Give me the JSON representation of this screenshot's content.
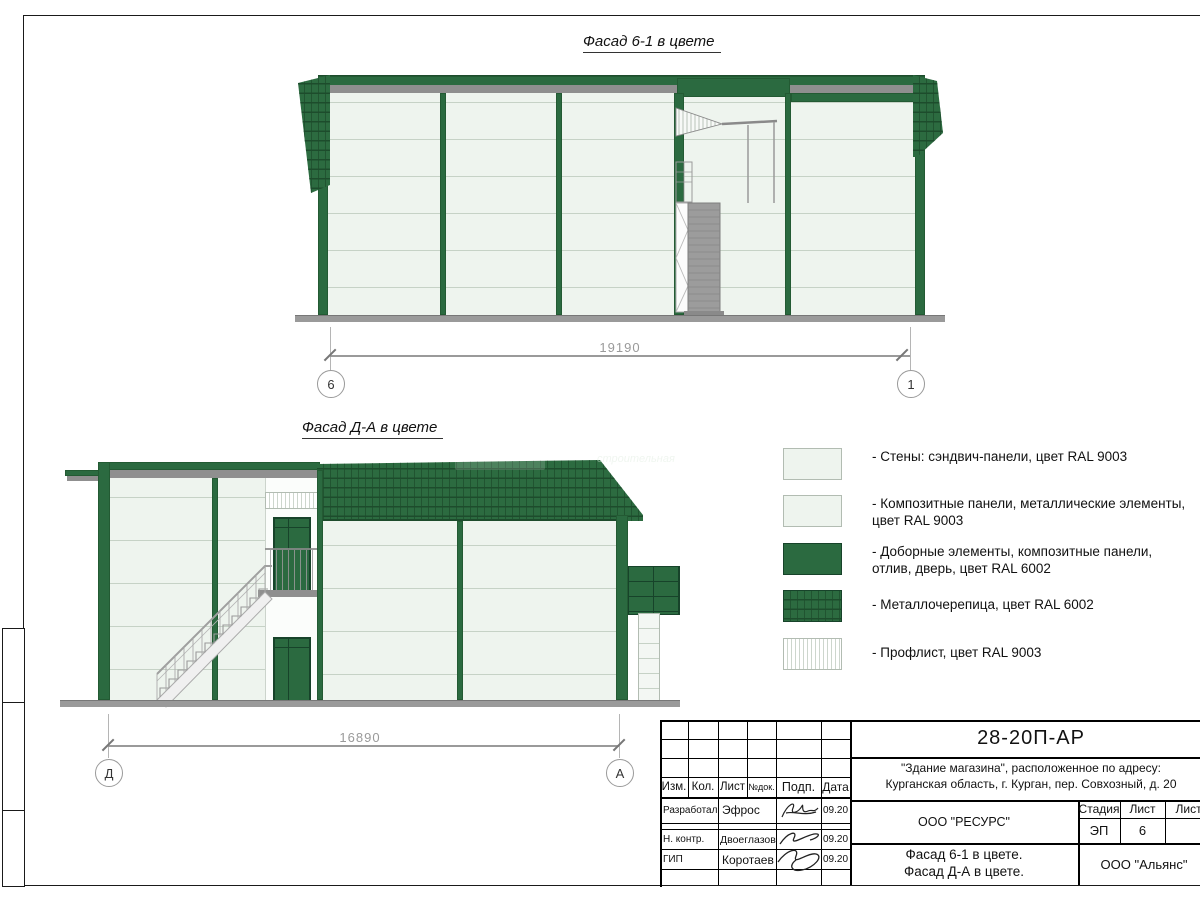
{
  "facades": {
    "f1": {
      "title": "Фасад 6-1 в цвете",
      "dimension": "19190",
      "axis_left": "6",
      "axis_right": "1"
    },
    "f2": {
      "title": "Фасад Д-А в цвете",
      "dimension": "16890",
      "axis_left": "Д",
      "axis_right": "А"
    }
  },
  "legend": {
    "items": [
      {
        "swatch": "plain-light",
        "lines": [
          "- Стены: сэндвич-панели, цвет RAL 9003"
        ]
      },
      {
        "swatch": "plain-light",
        "lines": [
          "- Композитные панели, металлические элементы,",
          "цвет RAL 9003"
        ]
      },
      {
        "swatch": "solid-green",
        "lines": [
          "- Доборные элементы,  композитные панели,",
          "отлив, дверь, цвет RAL 6002"
        ]
      },
      {
        "swatch": "tile-green",
        "lines": [
          "- Металлочерепица, цвет RAL 6002"
        ]
      },
      {
        "swatch": "proflist-light",
        "lines": [
          "- Профлист, цвет RAL 9003"
        ]
      }
    ]
  },
  "watermark": {
    "text": "строительная"
  },
  "title_block": {
    "doc_number": "28-20П-АР",
    "address_line1": "\"Здание магазина\", расположенное по адресу:",
    "address_line2": "Курганская область, г. Курган, пер. Совхозный, д. 20",
    "cols": [
      "Изм.",
      "Кол.",
      "Лист",
      "№док.",
      "Подп.",
      "Дата"
    ],
    "rows": [
      {
        "role": "Разработал",
        "name": "Эфрос",
        "date": "09.20"
      },
      {
        "role": "Н. контр.",
        "name": "Двоеглазов",
        "date": "09.20"
      },
      {
        "role": "ГИП",
        "name": "Коротаев",
        "date": "09.20"
      }
    ],
    "company": "ООО \"РЕСУРС\"",
    "stage_label": "Стадия",
    "sheet_label": "Лист",
    "sheets_label": "Листов",
    "stage_value": "ЭП",
    "sheet_value": "6",
    "title_line1": "Фасад 6-1 в цвете.",
    "title_line2": "Фасад Д-А в цвете.",
    "contractor": "ООО \"Альянс\""
  },
  "colors": {
    "green": "#2b6a40",
    "green_dark": "#1d4c2c",
    "panel_light": "#eef4ee",
    "metal_gray": "#8f8f8f"
  }
}
